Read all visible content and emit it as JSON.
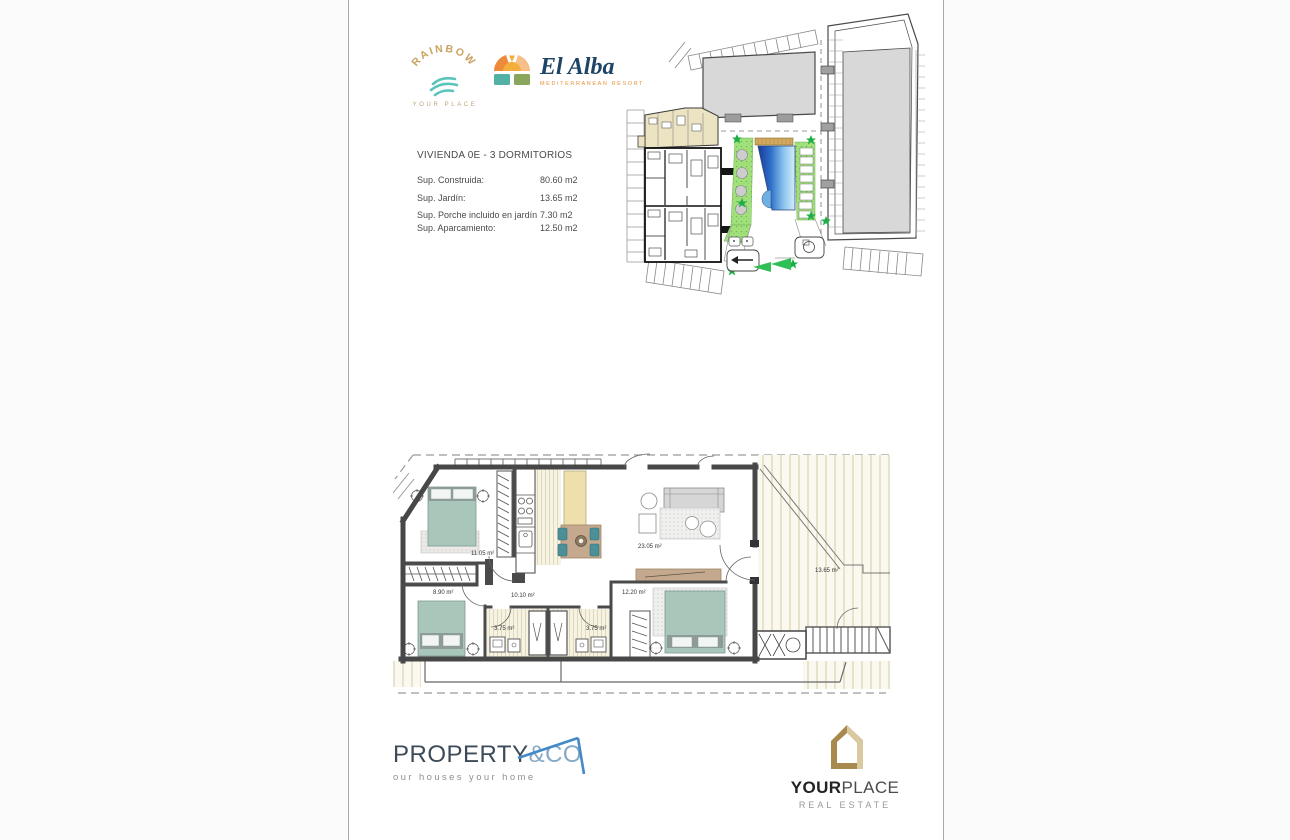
{
  "header": {
    "rainbow": {
      "name": "RAINBOW",
      "tagline": "YOUR PLACE"
    },
    "el_alba": {
      "name": "El Alba",
      "tagline": "MEDITERRANEAN RESORT"
    }
  },
  "property": {
    "title": "VIVIENDA 0E - 3 DORMITORIOS",
    "rows": [
      {
        "label": "Sup. Construida:",
        "value": "80.60 m2"
      },
      {
        "label": "Sup. Jardín:",
        "value": "13.65 m2"
      },
      {
        "label": "Sup. Porche incluido en jardín",
        "value": "7.30 m2"
      },
      {
        "label": "Sup. Aparcamiento:",
        "value": "12.50 m2"
      }
    ]
  },
  "floor_plan": {
    "rooms": [
      {
        "name": "bedroom-1",
        "area": "11.05 m²"
      },
      {
        "name": "bedroom-2",
        "area": "8.90 m²"
      },
      {
        "name": "hallway",
        "area": "10.10 m²"
      },
      {
        "name": "bathroom-1",
        "area": "3.75 m²"
      },
      {
        "name": "bathroom-2",
        "area": "3.75 m²"
      },
      {
        "name": "living-dining",
        "area": "23.05 m²"
      },
      {
        "name": "bedroom-3",
        "area": "12.20 m²"
      },
      {
        "name": "garden",
        "area": "13.65 m²"
      }
    ]
  },
  "footer": {
    "property_co": {
      "name": "PROPERTY",
      "suffix": "&CO",
      "tagline": "our houses your home"
    },
    "your_place": {
      "bold": "YOUR",
      "light": "PLACE",
      "tagline": "REAL ESTATE"
    }
  },
  "colors": {
    "brand_gold": "#c9a35e",
    "brand_teal": "#5bc4ba",
    "elalba_navy": "#1e4466",
    "elalba_orange": "#e8923c",
    "pco_slate": "#3d4a57",
    "pco_blue": "#85a9c4",
    "yplace_gold": "#a8894e",
    "yplace_tan": "#d9c8a0",
    "bed_teal": "#a9c6bb",
    "kitchen_beige": "#efdfad",
    "table_tan": "#c5a98e",
    "pool_blue_dark": "#1a3a9e",
    "pool_blue_light": "#d6edfa",
    "landscape_green": "#a4e17d",
    "star_green": "#1fae45",
    "highlight_unit_beige": "#ece3c3",
    "building_gray": "#d8d8d8"
  }
}
